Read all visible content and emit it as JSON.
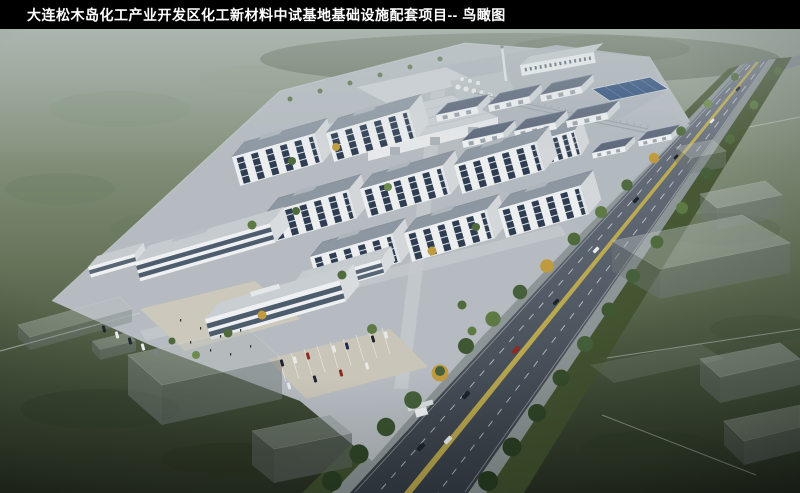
{
  "title_bar": {
    "title": "大连松木岛化工产业开发区化工新材料中试基地基础设施配套项目-- 鸟瞰图"
  },
  "palette": {
    "title_bar_bg": "#000000",
    "title_text": "#ffffff",
    "field_light": "#96a295",
    "field_dark": "#262d20",
    "campus_pavement": "#b5bbc0",
    "building_facade": "#eceef0",
    "window_glass": "#2e3d52",
    "roof_gray": "#8d97a2",
    "warehouse_roof": "#5b6679",
    "road_asphalt": "#555e68",
    "lane_marking_yellow": "#cdb64e",
    "lane_marking_white": "#e8e8e8",
    "tree_green": "#4f6a3c",
    "tree_autumn": "#c09a3e",
    "plaza_paving": "#ccc8bb",
    "ghost_block": "#aab2b2",
    "solar_panel": "#2f4f7c"
  }
}
